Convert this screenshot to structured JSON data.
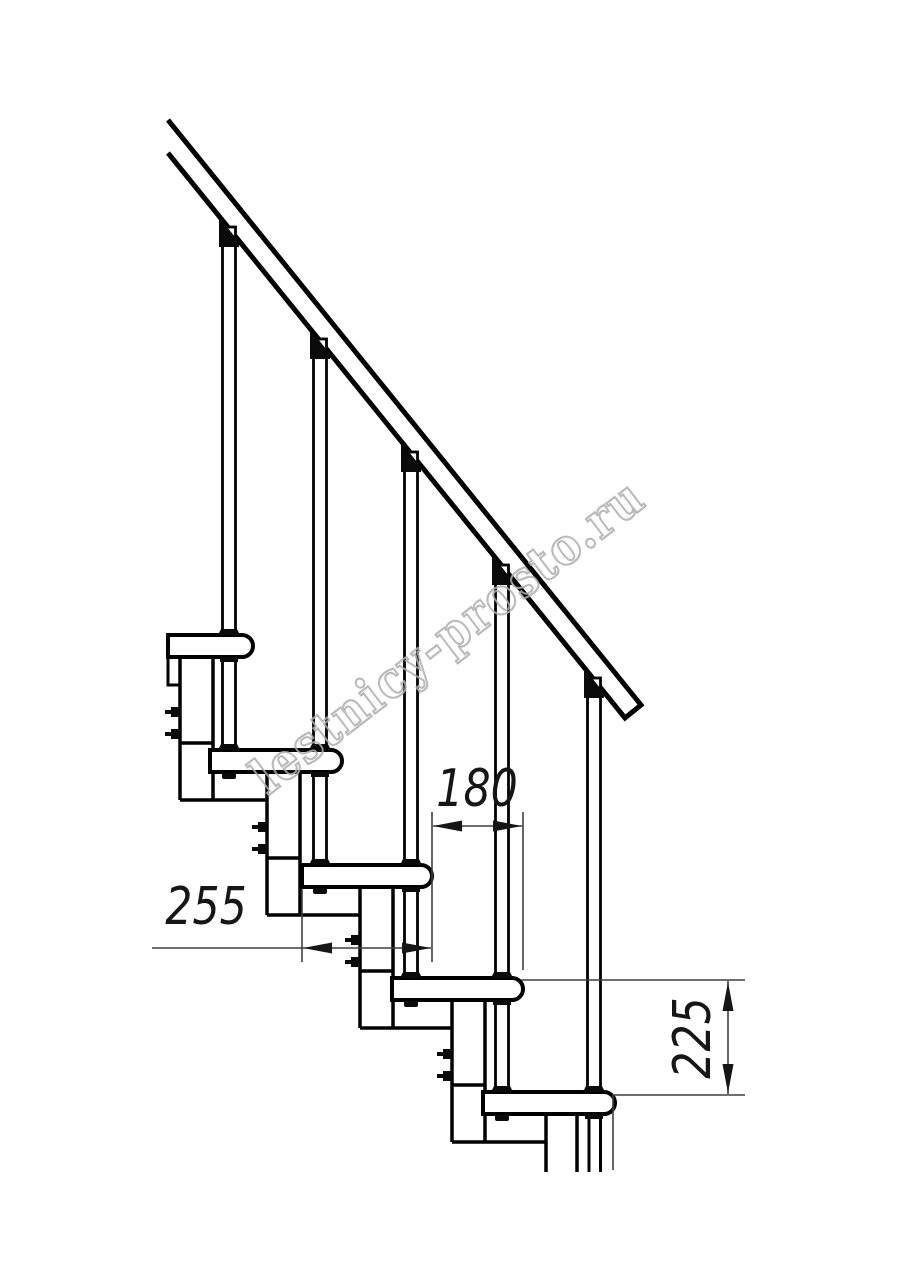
{
  "colors": {
    "background": "#ffffff",
    "line": "#000000",
    "hardware": "#0a0a0a",
    "dimension_line": "#3f3f3f",
    "dimension_text": "#161616",
    "watermark": "#aeaeae"
  },
  "dimensions": {
    "run": {
      "value": "180"
    },
    "depth": {
      "value": "255"
    },
    "rise": {
      "value": "225"
    }
  },
  "watermark": {
    "text": "lestnicy-prosto.ru"
  }
}
